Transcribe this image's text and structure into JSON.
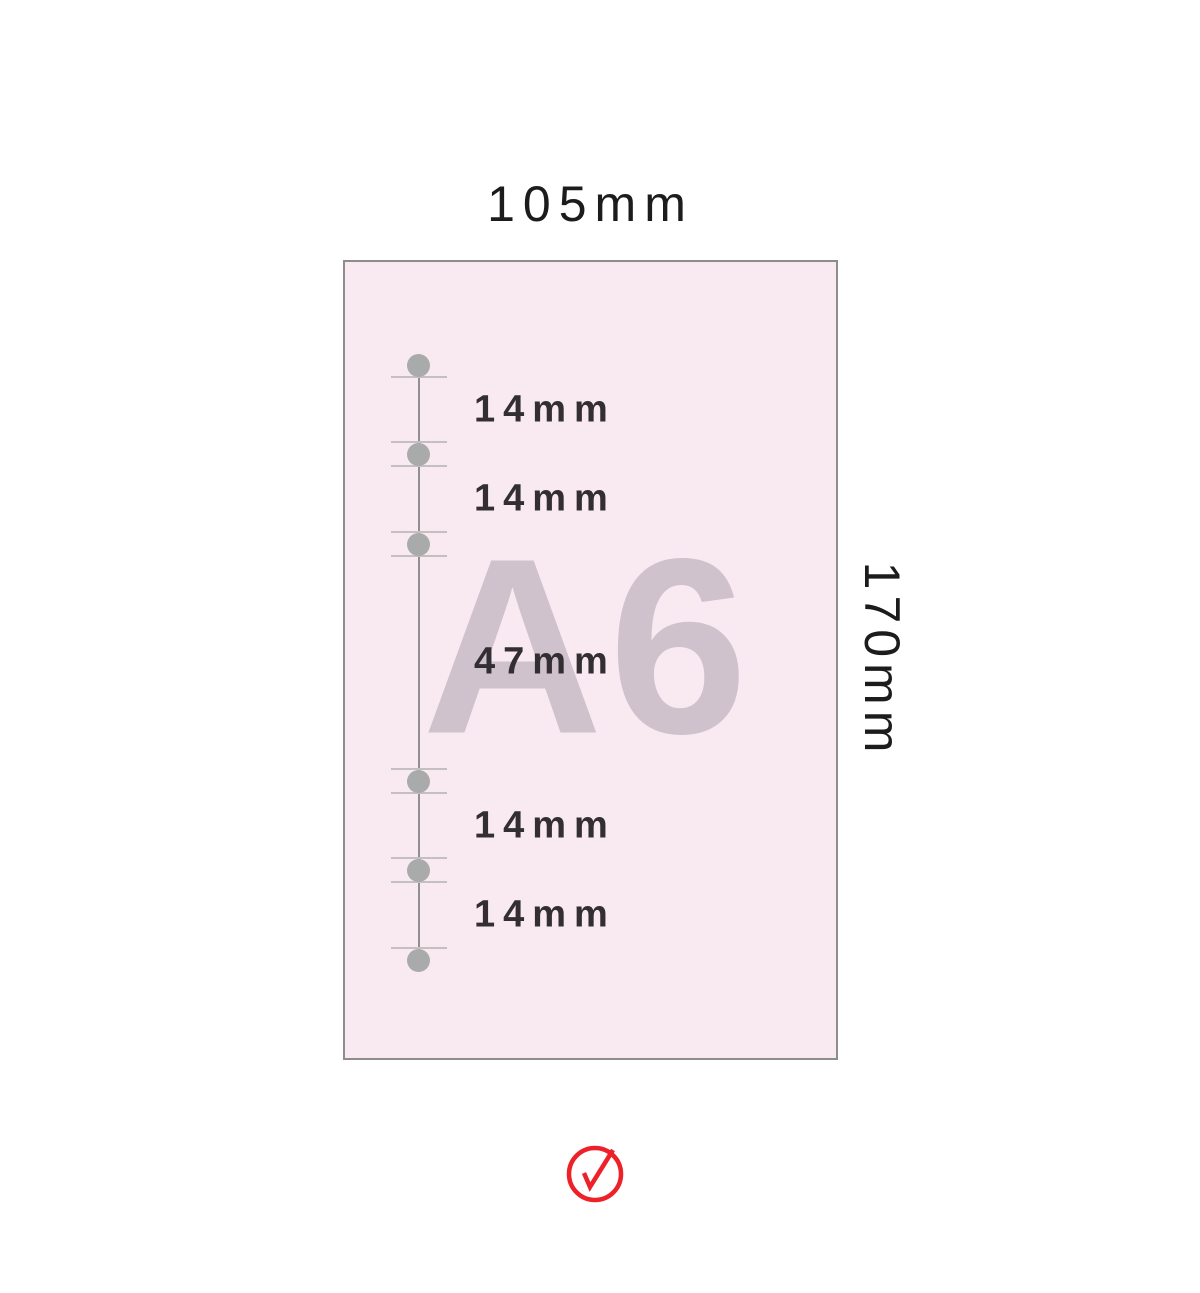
{
  "page": {
    "width_label": "105mm",
    "height_label": "170mm",
    "paper_label": "A6",
    "measurements": [
      "14mm",
      "14mm",
      "47mm",
      "14mm",
      "14mm"
    ],
    "icons": {
      "status": "check-circle-icon"
    },
    "colors": {
      "background": "#ffffff",
      "paper_fill": "#f9e9f1",
      "paper_border": "#8d8d8d",
      "watermark": "#cfc2cc",
      "hole_fill": "#a8aba9",
      "guide_line": "#909090",
      "tick_line": "#c4bfc1",
      "spacing_text": "#332e31",
      "dimension_text": "#1c1c1c",
      "check_red": "#ee2129"
    }
  }
}
